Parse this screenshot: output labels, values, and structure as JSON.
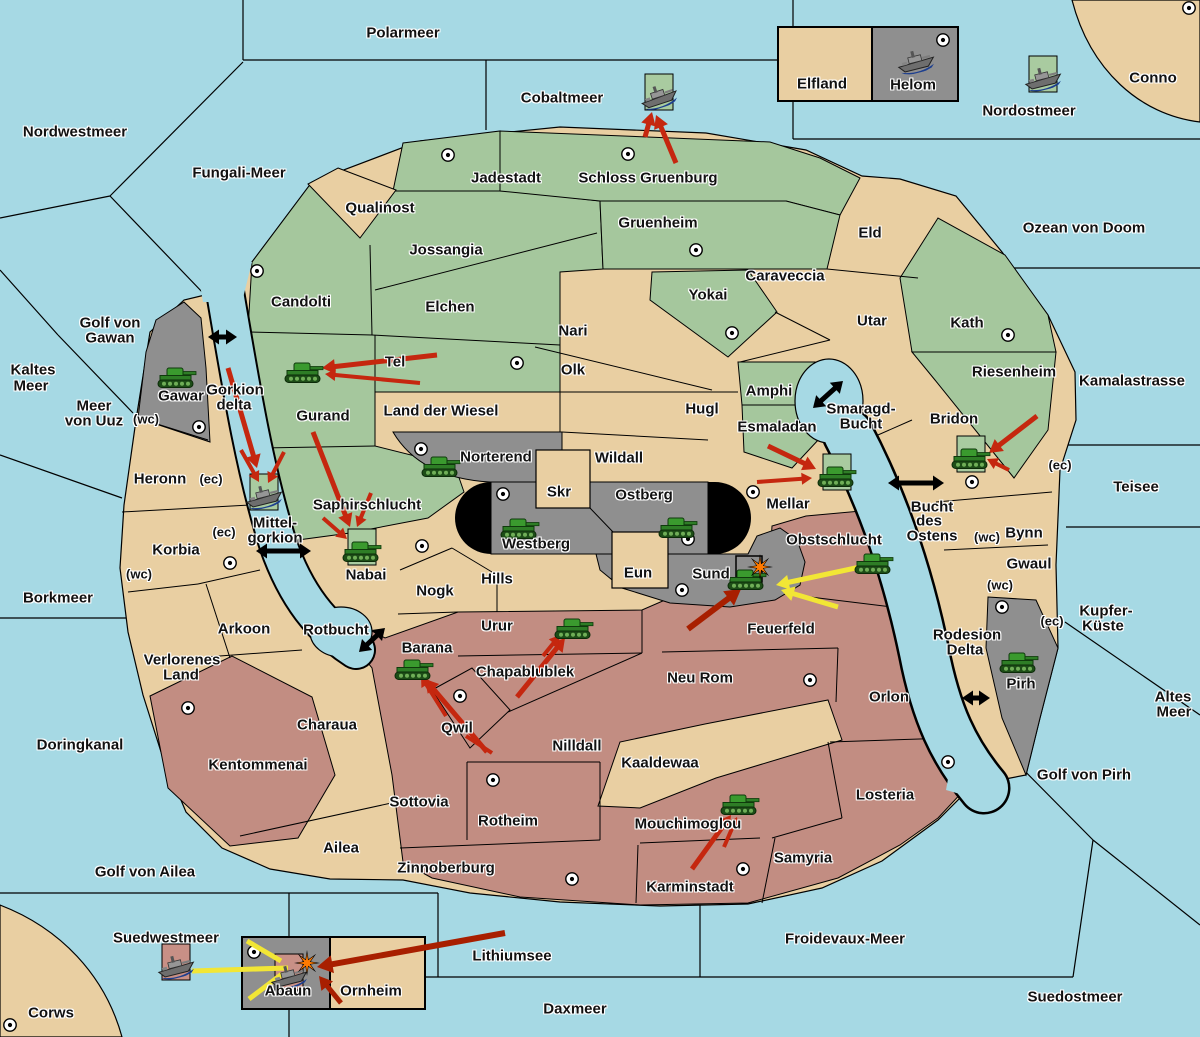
{
  "palette": {
    "water": "#a6d9e4",
    "land_tan": "#e9cfa2",
    "land_green": "#a5c79d",
    "land_red": "#c28d82",
    "land_gray": "#8f8f8f",
    "box_green": "#a9cba0",
    "box_pink": "#c89086",
    "arrow_red": "#c5270f",
    "arrow_dark_red": "#a81f00",
    "arrow_yellow": "#f2e635",
    "strait_black": "#000000",
    "explosion_orange": "#ff7a00",
    "border": "#000000"
  },
  "labels": [
    {
      "t": "Polarmeer",
      "x": 403,
      "y": 33,
      "k": "sea"
    },
    {
      "t": "Nordwestmeer",
      "x": 75,
      "y": 132,
      "k": "sea"
    },
    {
      "t": "Fungali-Meer",
      "x": 239,
      "y": 173,
      "k": "sea"
    },
    {
      "t": "Cobaltmeer",
      "x": 562,
      "y": 98,
      "k": "sea"
    },
    {
      "t": "Nordostmeer",
      "x": 1029,
      "y": 111,
      "k": "sea"
    },
    {
      "t": "Ozean von Doom",
      "x": 1084,
      "y": 228,
      "k": "sea"
    },
    {
      "t": "Kamalastrasse",
      "x": 1132,
      "y": 381,
      "k": "sea"
    },
    {
      "t": "Teisee",
      "x": 1136,
      "y": 487,
      "k": "sea"
    },
    {
      "t": "Kupfer-",
      "x": 1106,
      "y": 611,
      "k": "sea"
    },
    {
      "t": "Küste",
      "x": 1103,
      "y": 626,
      "k": "sea"
    },
    {
      "t": "Altes",
      "x": 1173,
      "y": 697,
      "k": "sea"
    },
    {
      "t": "Meer",
      "x": 1174,
      "y": 712,
      "k": "sea"
    },
    {
      "t": "Golf von Pirh",
      "x": 1084,
      "y": 775,
      "k": "sea"
    },
    {
      "t": "Kaltes",
      "x": 33,
      "y": 370,
      "k": "sea"
    },
    {
      "t": "Meer",
      "x": 31,
      "y": 386,
      "k": "sea"
    },
    {
      "t": "Golf von",
      "x": 110,
      "y": 323,
      "k": "sea"
    },
    {
      "t": "Gawan",
      "x": 110,
      "y": 338,
      "k": "sea"
    },
    {
      "t": "Meer",
      "x": 94,
      "y": 406,
      "k": "sea"
    },
    {
      "t": "von Uuz",
      "x": 94,
      "y": 421,
      "k": "sea"
    },
    {
      "t": "Gorkion",
      "x": 235,
      "y": 390,
      "k": "sea"
    },
    {
      "t": "delta",
      "x": 234,
      "y": 405,
      "k": "sea"
    },
    {
      "t": "Mittel-",
      "x": 275,
      "y": 523,
      "k": "sea"
    },
    {
      "t": "gorkion",
      "x": 275,
      "y": 538,
      "k": "sea"
    },
    {
      "t": "Smaragd-",
      "x": 861,
      "y": 409,
      "k": "sea"
    },
    {
      "t": "Bucht",
      "x": 861,
      "y": 424,
      "k": "sea"
    },
    {
      "t": "Bucht",
      "x": 932,
      "y": 507,
      "k": "sea"
    },
    {
      "t": "des",
      "x": 929,
      "y": 521,
      "k": "sea"
    },
    {
      "t": "Ostens",
      "x": 932,
      "y": 536,
      "k": "sea"
    },
    {
      "t": "Rodesion",
      "x": 967,
      "y": 635,
      "k": "sea"
    },
    {
      "t": "Delta",
      "x": 965,
      "y": 650,
      "k": "sea"
    },
    {
      "t": "Borkmeer",
      "x": 58,
      "y": 598,
      "k": "sea"
    },
    {
      "t": "Doringkanal",
      "x": 80,
      "y": 745,
      "k": "sea"
    },
    {
      "t": "Rotbucht",
      "x": 336,
      "y": 630,
      "k": "sea"
    },
    {
      "t": "Golf von Ailea",
      "x": 145,
      "y": 872,
      "k": "sea"
    },
    {
      "t": "Suedwestmeer",
      "x": 166,
      "y": 938,
      "k": "sea"
    },
    {
      "t": "Lithiumsee",
      "x": 512,
      "y": 956,
      "k": "sea"
    },
    {
      "t": "Daxmeer",
      "x": 575,
      "y": 1009,
      "k": "sea"
    },
    {
      "t": "Froidevaux-Meer",
      "x": 845,
      "y": 939,
      "k": "sea"
    },
    {
      "t": "Suedostmeer",
      "x": 1075,
      "y": 997,
      "k": "sea"
    },
    {
      "t": "Jadestadt",
      "x": 506,
      "y": 178,
      "k": "land"
    },
    {
      "t": "Schloss Gruenburg",
      "x": 648,
      "y": 178,
      "k": "land"
    },
    {
      "t": "Gruenheim",
      "x": 658,
      "y": 223,
      "k": "land"
    },
    {
      "t": "Qualinost",
      "x": 380,
      "y": 208,
      "k": "land"
    },
    {
      "t": "Jossangia",
      "x": 446,
      "y": 250,
      "k": "land"
    },
    {
      "t": "Elchen",
      "x": 450,
      "y": 307,
      "k": "land"
    },
    {
      "t": "Candolti",
      "x": 301,
      "y": 302,
      "k": "land"
    },
    {
      "t": "Tel",
      "x": 395,
      "y": 362,
      "k": "land"
    },
    {
      "t": "Gurand",
      "x": 323,
      "y": 416,
      "k": "land"
    },
    {
      "t": "Land der Wiesel",
      "x": 441,
      "y": 411,
      "k": "land"
    },
    {
      "t": "Nari",
      "x": 573,
      "y": 331,
      "k": "land"
    },
    {
      "t": "Olk",
      "x": 573,
      "y": 370,
      "k": "land"
    },
    {
      "t": "Yokai",
      "x": 708,
      "y": 295,
      "k": "land"
    },
    {
      "t": "Caraveccia",
      "x": 785,
      "y": 276,
      "k": "land"
    },
    {
      "t": "Eld",
      "x": 870,
      "y": 233,
      "k": "land"
    },
    {
      "t": "Utar",
      "x": 872,
      "y": 321,
      "k": "land"
    },
    {
      "t": "Kath",
      "x": 967,
      "y": 323,
      "k": "land"
    },
    {
      "t": "Riesenheim",
      "x": 1014,
      "y": 372,
      "k": "land"
    },
    {
      "t": "Bridon",
      "x": 954,
      "y": 419,
      "k": "land"
    },
    {
      "t": "Amphi",
      "x": 769,
      "y": 391,
      "k": "land"
    },
    {
      "t": "Esmaladan",
      "x": 777,
      "y": 427,
      "k": "land"
    },
    {
      "t": "Hugl",
      "x": 702,
      "y": 409,
      "k": "land"
    },
    {
      "t": "Wildall",
      "x": 619,
      "y": 458,
      "k": "land"
    },
    {
      "t": "Norterend",
      "x": 496,
      "y": 457,
      "k": "land"
    },
    {
      "t": "Skr",
      "x": 559,
      "y": 492,
      "k": "land"
    },
    {
      "t": "Ostberg",
      "x": 644,
      "y": 495,
      "k": "land"
    },
    {
      "t": "Westberg",
      "x": 536,
      "y": 544,
      "k": "land"
    },
    {
      "t": "Mellar",
      "x": 788,
      "y": 504,
      "k": "land"
    },
    {
      "t": "Saphirschlucht",
      "x": 367,
      "y": 505,
      "k": "land"
    },
    {
      "t": "Nabai",
      "x": 366,
      "y": 575,
      "k": "land"
    },
    {
      "t": "Eun",
      "x": 638,
      "y": 573,
      "k": "land"
    },
    {
      "t": "Sund",
      "x": 711,
      "y": 574,
      "k": "land"
    },
    {
      "t": "Hills",
      "x": 497,
      "y": 579,
      "k": "land"
    },
    {
      "t": "Nogk",
      "x": 435,
      "y": 591,
      "k": "land"
    },
    {
      "t": "Obstschlucht",
      "x": 834,
      "y": 540,
      "k": "land"
    },
    {
      "t": "Feuerfeld",
      "x": 781,
      "y": 629,
      "k": "land"
    },
    {
      "t": "Urur",
      "x": 497,
      "y": 626,
      "k": "land"
    },
    {
      "t": "Barana",
      "x": 427,
      "y": 648,
      "k": "land"
    },
    {
      "t": "Chapablublek",
      "x": 525,
      "y": 672,
      "k": "land"
    },
    {
      "t": "Qwil",
      "x": 457,
      "y": 728,
      "k": "land"
    },
    {
      "t": "Nilldall",
      "x": 577,
      "y": 746,
      "k": "land"
    },
    {
      "t": "Kaaldewaa",
      "x": 660,
      "y": 763,
      "k": "land"
    },
    {
      "t": "Neu Rom",
      "x": 700,
      "y": 678,
      "k": "land"
    },
    {
      "t": "Orlon",
      "x": 889,
      "y": 697,
      "k": "land"
    },
    {
      "t": "Losteria",
      "x": 885,
      "y": 795,
      "k": "land"
    },
    {
      "t": "Samyria",
      "x": 803,
      "y": 858,
      "k": "land"
    },
    {
      "t": "Mouchimoglou",
      "x": 688,
      "y": 824,
      "k": "land"
    },
    {
      "t": "Karminstadt",
      "x": 690,
      "y": 887,
      "k": "land"
    },
    {
      "t": "Zinnoberburg",
      "x": 446,
      "y": 868,
      "k": "land"
    },
    {
      "t": "Rotheim",
      "x": 508,
      "y": 821,
      "k": "land"
    },
    {
      "t": "Sottovia",
      "x": 419,
      "y": 802,
      "k": "land"
    },
    {
      "t": "Heronn",
      "x": 160,
      "y": 479,
      "k": "land"
    },
    {
      "t": "Korbia",
      "x": 176,
      "y": 550,
      "k": "land"
    },
    {
      "t": "Arkoon",
      "x": 244,
      "y": 629,
      "k": "land"
    },
    {
      "t": "Verlorenes",
      "x": 182,
      "y": 660,
      "k": "land"
    },
    {
      "t": "Land",
      "x": 181,
      "y": 675,
      "k": "land"
    },
    {
      "t": "Charaua",
      "x": 327,
      "y": 725,
      "k": "land"
    },
    {
      "t": "Kentommenai",
      "x": 258,
      "y": 765,
      "k": "land"
    },
    {
      "t": "Ailea",
      "x": 341,
      "y": 848,
      "k": "land"
    },
    {
      "t": "Gawar",
      "x": 181,
      "y": 396,
      "k": "land"
    },
    {
      "t": "Bynn",
      "x": 1024,
      "y": 533,
      "k": "land"
    },
    {
      "t": "Gwaul",
      "x": 1029,
      "y": 564,
      "k": "land"
    },
    {
      "t": "Pirh",
      "x": 1021,
      "y": 684,
      "k": "land"
    },
    {
      "t": "Abaun",
      "x": 288,
      "y": 991,
      "k": "land"
    },
    {
      "t": "Ornheim",
      "x": 371,
      "y": 991,
      "k": "land"
    },
    {
      "t": "Elfland",
      "x": 822,
      "y": 84,
      "k": "land"
    },
    {
      "t": "Helom",
      "x": 913,
      "y": 85,
      "k": "land"
    },
    {
      "t": "Conno",
      "x": 1153,
      "y": 78,
      "k": "land"
    },
    {
      "t": "Corws",
      "x": 51,
      "y": 1013,
      "k": "land"
    },
    {
      "t": "(wc)",
      "x": 146,
      "y": 419,
      "k": "tag"
    },
    {
      "t": "(ec)",
      "x": 211,
      "y": 479,
      "k": "tag"
    },
    {
      "t": "(ec)",
      "x": 224,
      "y": 532,
      "k": "tag"
    },
    {
      "t": "(wc)",
      "x": 139,
      "y": 574,
      "k": "tag"
    },
    {
      "t": "(ec)",
      "x": 1060,
      "y": 465,
      "k": "tag"
    },
    {
      "t": "(wc)",
      "x": 987,
      "y": 537,
      "k": "tag"
    },
    {
      "t": "(wc)",
      "x": 1000,
      "y": 585,
      "k": "tag"
    },
    {
      "t": "(ec)",
      "x": 1052,
      "y": 621,
      "k": "tag"
    }
  ],
  "supply_centers": [
    [
      448,
      155
    ],
    [
      628,
      154
    ],
    [
      696,
      250
    ],
    [
      257,
      271
    ],
    [
      732,
      333
    ],
    [
      1008,
      335
    ],
    [
      517,
      363
    ],
    [
      199,
      427
    ],
    [
      421,
      449
    ],
    [
      503,
      494
    ],
    [
      753,
      492
    ],
    [
      972,
      482
    ],
    [
      688,
      539
    ],
    [
      682,
      590
    ],
    [
      422,
      546
    ],
    [
      230,
      563
    ],
    [
      460,
      696
    ],
    [
      493,
      780
    ],
    [
      572,
      879
    ],
    [
      743,
      869
    ],
    [
      948,
      762
    ],
    [
      810,
      680
    ],
    [
      1002,
      607
    ],
    [
      943,
      40
    ],
    [
      1189,
      8
    ],
    [
      10,
      1025
    ],
    [
      254,
      952
    ],
    [
      188,
      708
    ]
  ],
  "units": [
    {
      "kind": "ship",
      "loc": "Cobaltmeer",
      "x": 659,
      "y": 97,
      "box": "green",
      "rot": -18
    },
    {
      "kind": "ship",
      "loc": "Helom",
      "x": 916,
      "y": 62,
      "box": null,
      "rot": -14
    },
    {
      "kind": "ship",
      "loc": "Nordostmeer",
      "x": 1043,
      "y": 79,
      "box": "green",
      "rot": -14
    },
    {
      "kind": "tank",
      "loc": "Gawar",
      "x": 177,
      "y": 378,
      "box": null,
      "rot": 0
    },
    {
      "kind": "tank",
      "loc": "Gurand",
      "x": 304,
      "y": 373,
      "box": null,
      "rot": 0
    },
    {
      "kind": "tank",
      "loc": "Norterend",
      "x": 441,
      "y": 467,
      "box": null,
      "rot": 0
    },
    {
      "kind": "tank",
      "loc": "Westberg",
      "x": 520,
      "y": 529,
      "box": null,
      "rot": 0
    },
    {
      "kind": "tank",
      "loc": "Ostberg",
      "x": 678,
      "y": 528,
      "box": null,
      "rot": 0
    },
    {
      "kind": "tank",
      "loc": "Mellar",
      "x": 837,
      "y": 477,
      "box": "green",
      "rot": 0
    },
    {
      "kind": "tank",
      "loc": "Bridon",
      "x": 971,
      "y": 459,
      "box": "green",
      "rot": 0
    },
    {
      "kind": "ship",
      "loc": "Mittel-gorkion",
      "x": 264,
      "y": 497,
      "box": "green",
      "rot": -14
    },
    {
      "kind": "tank",
      "loc": "Nabai",
      "x": 362,
      "y": 552,
      "box": "green",
      "rot": 0
    },
    {
      "kind": "tank",
      "loc": "Sund",
      "x": 747,
      "y": 580,
      "box": null,
      "rot": 0
    },
    {
      "kind": "tank",
      "loc": "Obstschlucht",
      "x": 874,
      "y": 564,
      "box": null,
      "rot": 0
    },
    {
      "kind": "tank",
      "loc": "Urur",
      "x": 574,
      "y": 629,
      "box": null,
      "rot": 0
    },
    {
      "kind": "tank",
      "loc": "Barana",
      "x": 414,
      "y": 670,
      "box": null,
      "rot": 0
    },
    {
      "kind": "tank",
      "loc": "Mouchimoglou",
      "x": 740,
      "y": 805,
      "box": null,
      "rot": 0
    },
    {
      "kind": "tank",
      "loc": "Pirh",
      "x": 1019,
      "y": 663,
      "box": null,
      "rot": 0
    },
    {
      "kind": "ship",
      "loc": "Suedwestmeer",
      "x": 176,
      "y": 967,
      "box": "pink",
      "rot": -14
    },
    {
      "kind": "ship",
      "loc": "Abaun",
      "x": 289,
      "y": 977,
      "box": "pink",
      "rot": -14
    }
  ],
  "explosions": [
    {
      "x": 760,
      "y": 567
    },
    {
      "x": 307,
      "y": 963
    }
  ],
  "empty_box": {
    "x": 736,
    "y": 556,
    "w": 26,
    "h": 26
  },
  "arrows": {
    "red": [
      {
        "x1": 676,
        "y1": 163,
        "x2": 656,
        "y2": 115,
        "w": 5,
        "head": 1
      },
      {
        "x1": 645,
        "y1": 137,
        "x2": 652,
        "y2": 112,
        "w": 5,
        "head": 1
      },
      {
        "x1": 437,
        "y1": 355,
        "x2": 322,
        "y2": 368,
        "w": 5,
        "head": 1
      },
      {
        "x1": 420,
        "y1": 383,
        "x2": 325,
        "y2": 374,
        "w": 4,
        "head": 1
      },
      {
        "x1": 228,
        "y1": 368,
        "x2": 257,
        "y2": 468,
        "w": 5,
        "head": 1
      },
      {
        "x1": 241,
        "y1": 450,
        "x2": 259,
        "y2": 482,
        "w": 4,
        "head": 1
      },
      {
        "x1": 284,
        "y1": 452,
        "x2": 268,
        "y2": 483,
        "w": 4,
        "head": 1
      },
      {
        "x1": 313,
        "y1": 432,
        "x2": 350,
        "y2": 527,
        "w": 5,
        "head": 1
      },
      {
        "x1": 323,
        "y1": 518,
        "x2": 347,
        "y2": 539,
        "w": 4,
        "head": 1
      },
      {
        "x1": 371,
        "y1": 493,
        "x2": 357,
        "y2": 527,
        "w": 4,
        "head": 1
      },
      {
        "x1": 768,
        "y1": 446,
        "x2": 816,
        "y2": 469,
        "w": 5,
        "head": 1
      },
      {
        "x1": 757,
        "y1": 482,
        "x2": 812,
        "y2": 478,
        "w": 4,
        "head": 1
      },
      {
        "x1": 1037,
        "y1": 416,
        "x2": 989,
        "y2": 453,
        "w": 5,
        "head": 1
      },
      {
        "x1": 1009,
        "y1": 470,
        "x2": 987,
        "y2": 459,
        "w": 4,
        "head": 1
      },
      {
        "x1": 517,
        "y1": 697,
        "x2": 565,
        "y2": 638,
        "w": 5,
        "head": 1
      },
      {
        "x1": 543,
        "y1": 656,
        "x2": 560,
        "y2": 635,
        "w": 4,
        "head": 1
      },
      {
        "x1": 487,
        "y1": 752,
        "x2": 425,
        "y2": 679,
        "w": 5,
        "head": 1
      },
      {
        "x1": 446,
        "y1": 716,
        "x2": 421,
        "y2": 676,
        "w": 4,
        "head": 1
      },
      {
        "x1": 466,
        "y1": 736,
        "x2": 492,
        "y2": 753,
        "w": 4,
        "head": 0
      },
      {
        "x1": 692,
        "y1": 869,
        "x2": 731,
        "y2": 815,
        "w": 5,
        "head": 1
      },
      {
        "x1": 724,
        "y1": 847,
        "x2": 737,
        "y2": 817,
        "w": 4,
        "head": 1
      }
    ],
    "dark_red": [
      {
        "x1": 688,
        "y1": 629,
        "x2": 741,
        "y2": 589,
        "w": 6,
        "head": 1
      },
      {
        "x1": 505,
        "y1": 933,
        "x2": 317,
        "y2": 967,
        "w": 6,
        "head": 1
      },
      {
        "x1": 341,
        "y1": 1003,
        "x2": 319,
        "y2": 976,
        "w": 5,
        "head": 1
      }
    ],
    "yellow": [
      {
        "x1": 192,
        "y1": 971,
        "x2": 288,
        "y2": 968,
        "w": 5,
        "head": 0
      },
      {
        "x1": 281,
        "y1": 961,
        "x2": 247,
        "y2": 941,
        "w": 5,
        "head": 0
      },
      {
        "x1": 282,
        "y1": 974,
        "x2": 249,
        "y2": 999,
        "w": 5,
        "head": 0
      },
      {
        "x1": 865,
        "y1": 566,
        "x2": 776,
        "y2": 585,
        "w": 5,
        "head": 1
      },
      {
        "x1": 838,
        "y1": 607,
        "x2": 781,
        "y2": 590,
        "w": 5,
        "head": 1
      }
    ],
    "straits": [
      {
        "x1": 208,
        "y1": 337,
        "x2": 237,
        "y2": 337
      },
      {
        "x1": 256,
        "y1": 551,
        "x2": 311,
        "y2": 551
      },
      {
        "x1": 359,
        "y1": 652,
        "x2": 385,
        "y2": 628
      },
      {
        "x1": 813,
        "y1": 408,
        "x2": 843,
        "y2": 381
      },
      {
        "x1": 888,
        "y1": 483,
        "x2": 944,
        "y2": 483
      },
      {
        "x1": 962,
        "y1": 698,
        "x2": 990,
        "y2": 698
      }
    ]
  }
}
